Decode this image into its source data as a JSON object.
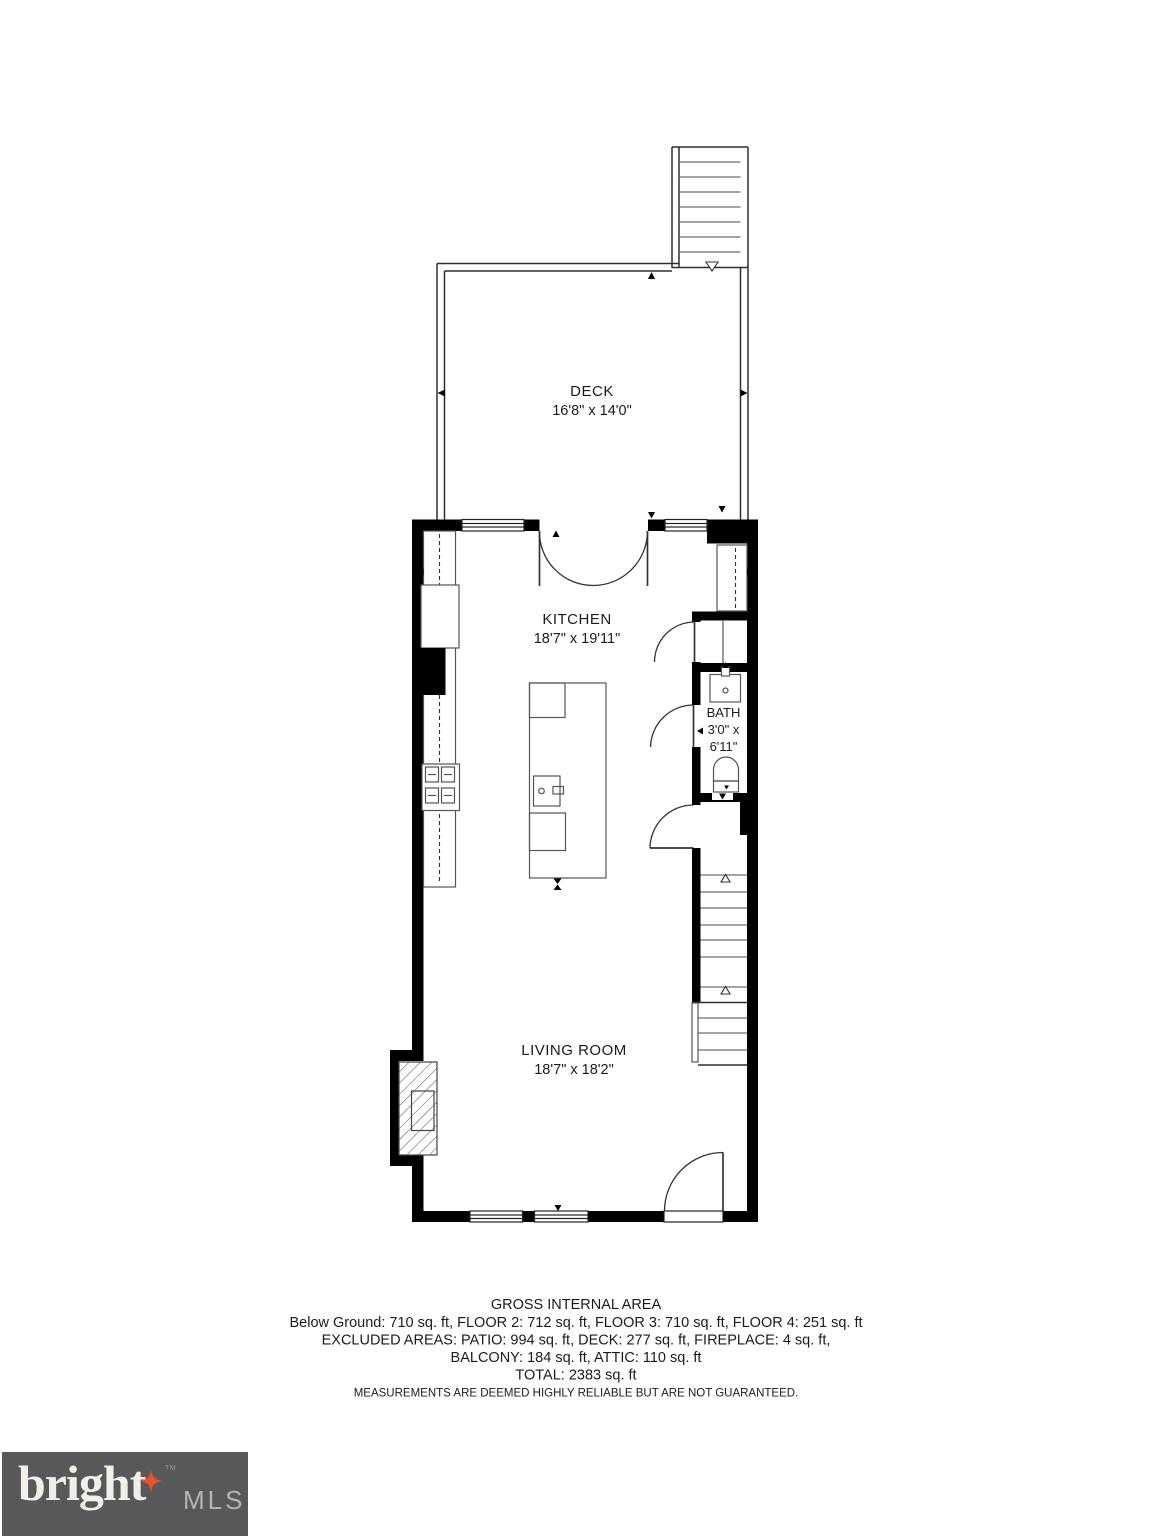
{
  "floorplan": {
    "deck": {
      "label": "DECK",
      "dims": "16'8\" x 14'0\""
    },
    "kitchen": {
      "label": "KITCHEN",
      "dims": "18'7\" x 19'11\""
    },
    "bath": {
      "label": "BATH",
      "dims_line1": "3'0\" x",
      "dims_line2": "6'11\""
    },
    "living_room": {
      "label": "LIVING ROOM",
      "dims": "18'7\" x 18'2\""
    }
  },
  "summary": {
    "title": "GROSS INTERNAL AREA",
    "line1": "Below Ground: 710 sq. ft, FLOOR 2: 712 sq. ft, FLOOR 3: 710 sq. ft, FLOOR 4: 251 sq. ft",
    "line2": "EXCLUDED AREAS: PATIO: 994 sq. ft, DECK: 277 sq. ft, FIREPLACE: 4 sq. ft,",
    "line3": "BALCONY: 184 sq. ft, ATTIC: 110 sq. ft",
    "total": "TOTAL: 2383 sq. ft",
    "disclaimer": "MEASUREMENTS ARE DEEMED HIGHLY RELIABLE BUT ARE NOT GUARANTEED."
  },
  "logo": {
    "brand": "bright",
    "trademark": "TM",
    "suffix": "MLS",
    "background_color": "#58585a",
    "star_color": "#e4532a",
    "brand_color": "#f2efe9",
    "suffix_color": "#b2b3b5"
  }
}
